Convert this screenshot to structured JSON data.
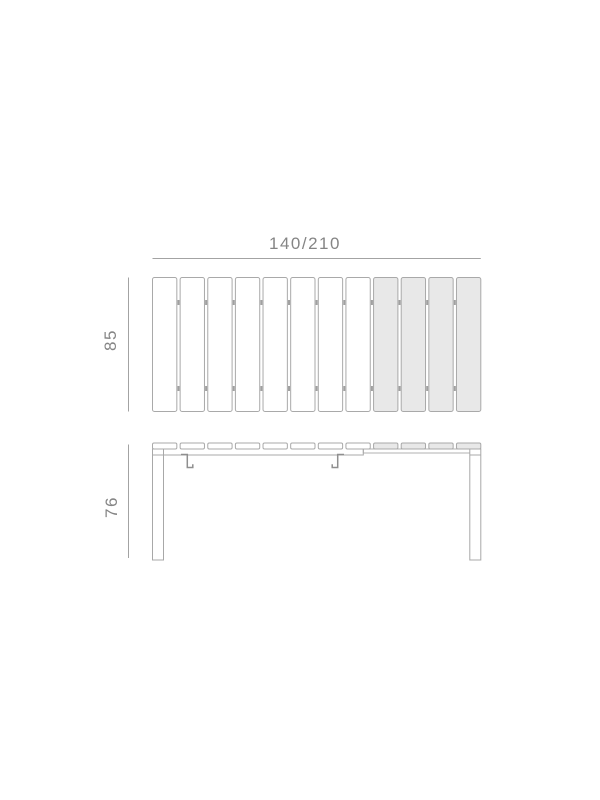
{
  "drawing": {
    "type": "extendable-table-dimension-diagram",
    "top_view": {
      "width_label": "140/210",
      "depth_label": "85",
      "slats_total": 12,
      "slats_fixed": 8,
      "slats_extension": 4
    },
    "side_view": {
      "height_label": "76",
      "legs": 2,
      "latch_brackets": 2
    },
    "colors": {
      "background": "#ffffff",
      "slat_fill_fixed": "#ffffff",
      "slat_fill_extension": "#e8e8e8",
      "slat_outline": "#a9a9a9",
      "structure_line": "#a8a8a8",
      "dimension_line": "#a3a3a3",
      "dimension_text": "#858585",
      "joint_tick": "#8f8f8f"
    }
  }
}
